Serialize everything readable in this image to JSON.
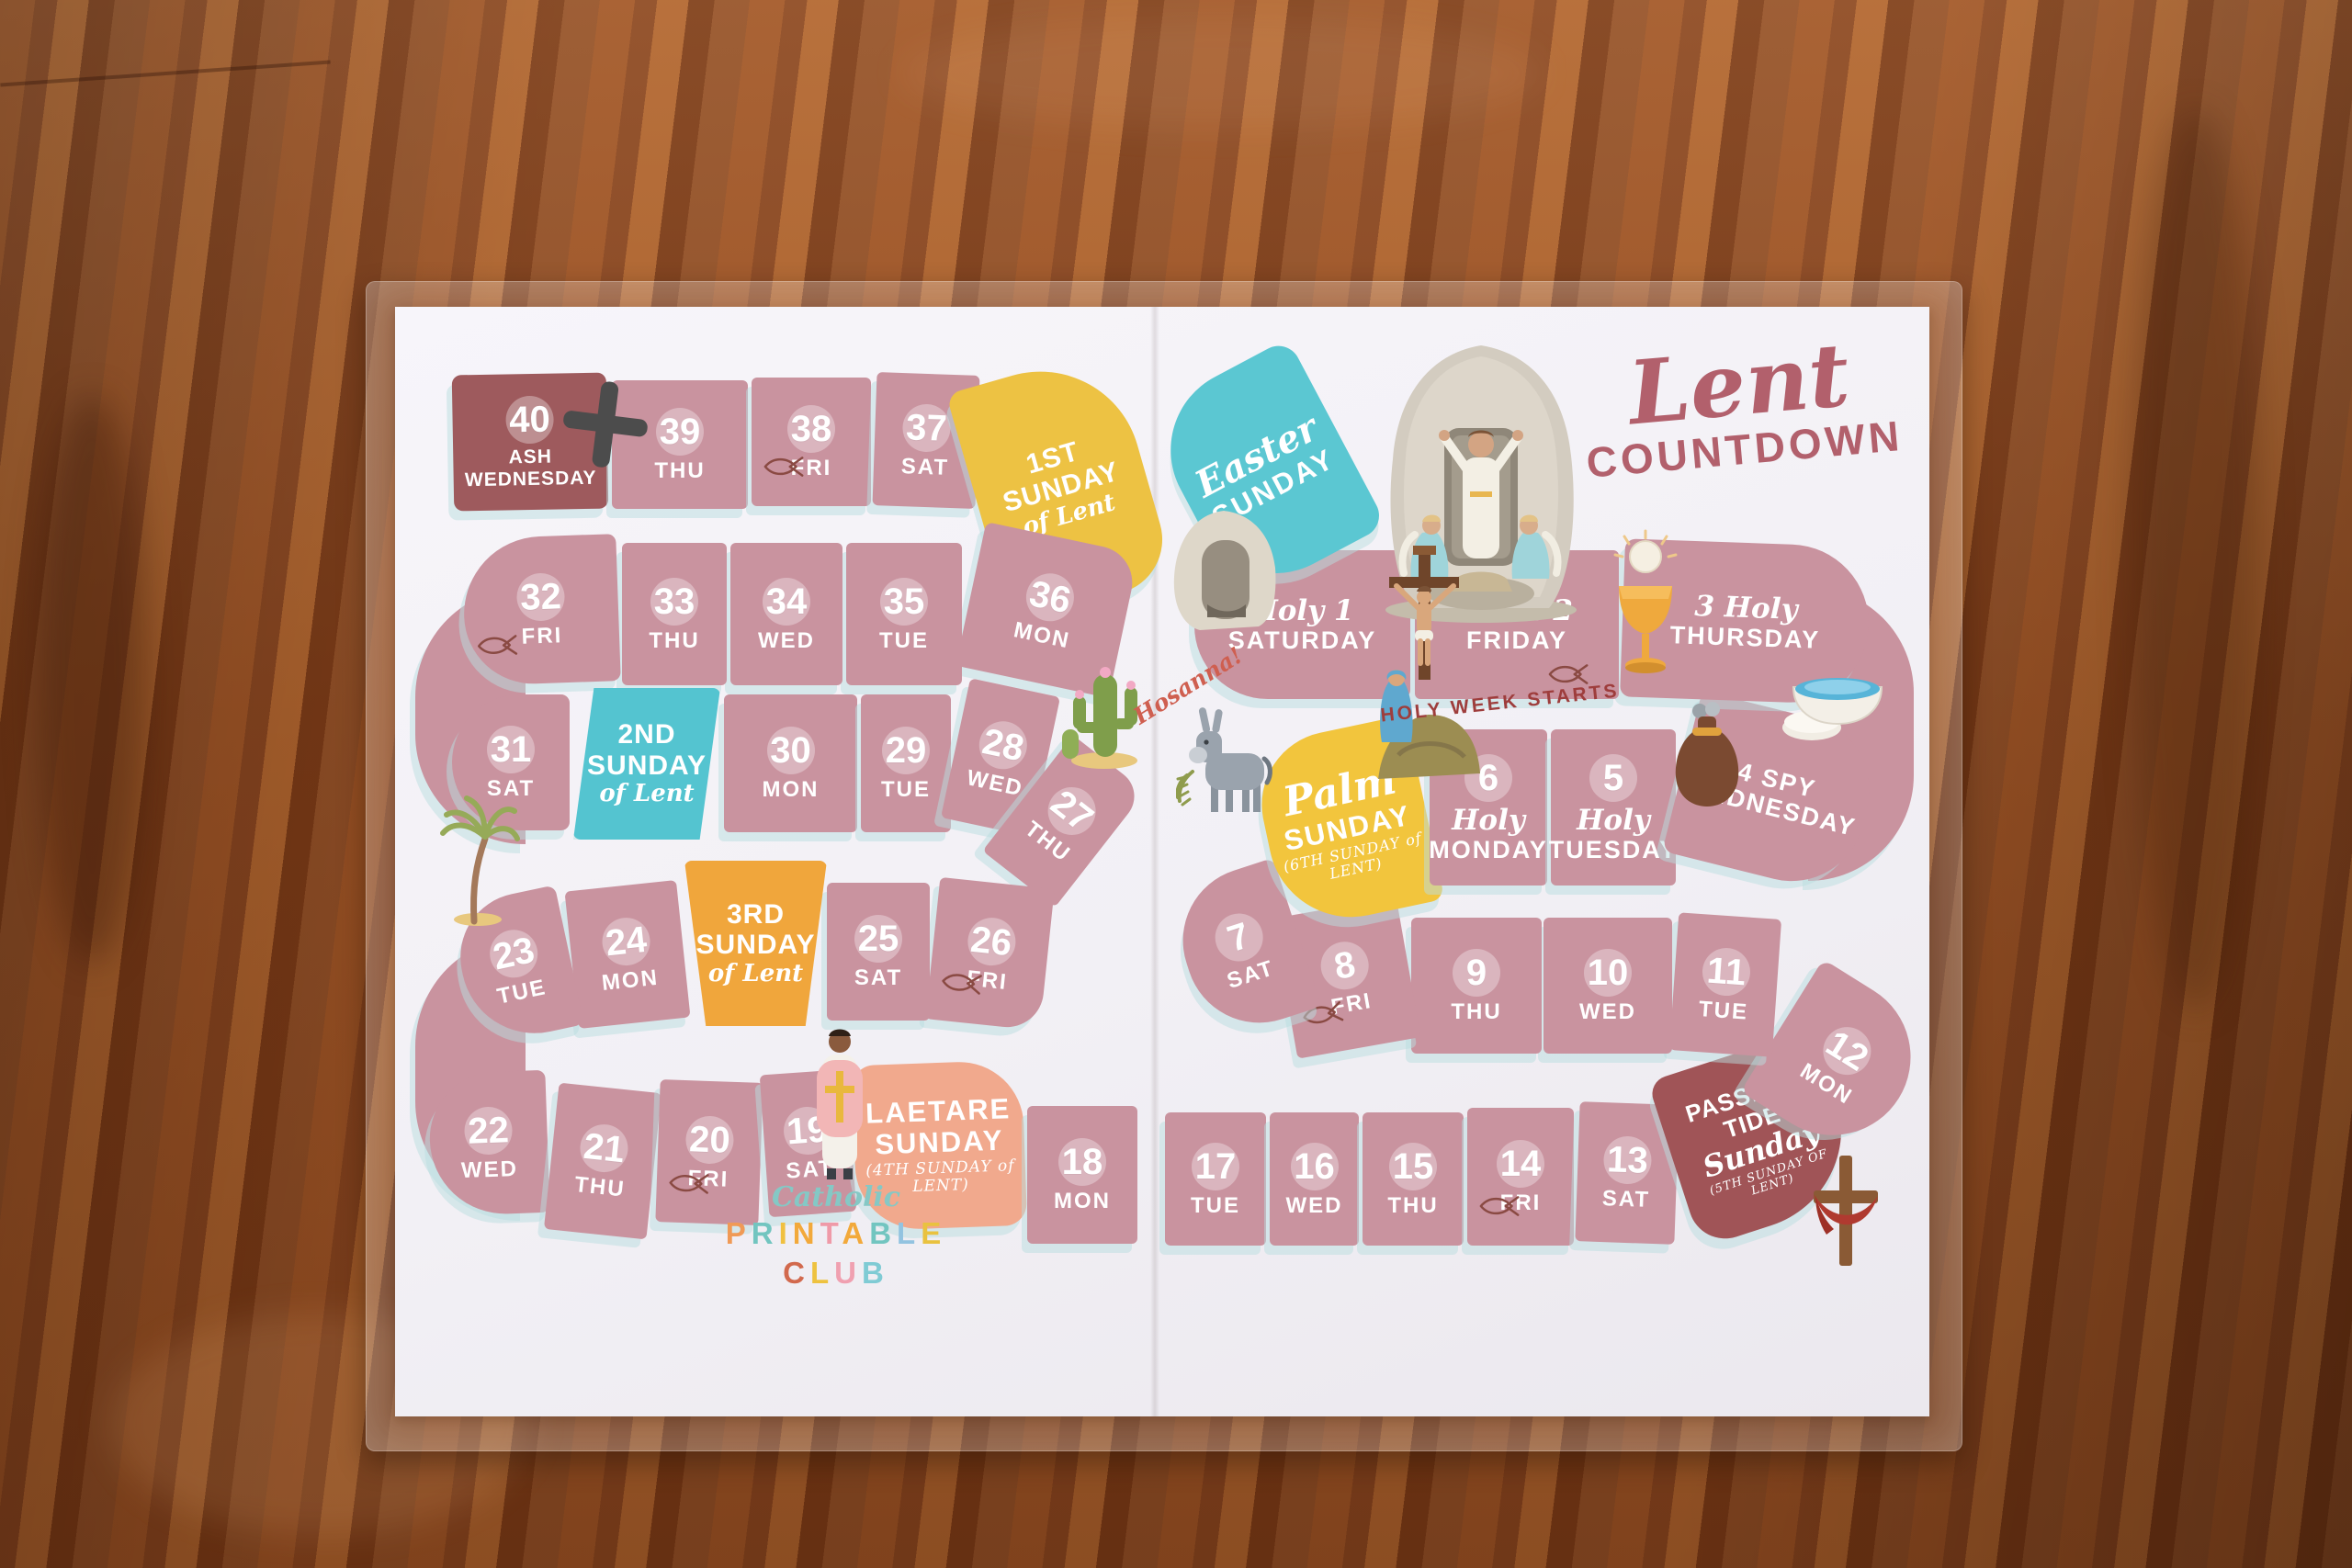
{
  "title": {
    "script": "Lent",
    "caps": "COUNTDOWN"
  },
  "annotations": {
    "hosanna": "Hosanna!",
    "holy_week": "HOLY WEEK STARTS"
  },
  "logo": {
    "script": "Catholic",
    "word1": "PRINTABLE",
    "word1_colors": [
      "#f09a56",
      "#72c5c0",
      "#f0c040",
      "#f2a93b",
      "#ef9aa8",
      "#f2a93b",
      "#72c5c0",
      "#92c3e0",
      "#e9c23f"
    ],
    "word2": "CLUB",
    "word2_colors": [
      "#d2694d",
      "#eec23f",
      "#f0a0b0",
      "#7fcbd4"
    ]
  },
  "colors": {
    "day": "#c9939f",
    "holy": "#c9939f",
    "ash": "#9e5a5d",
    "sunday1": "#edc243",
    "sunday2": "#54c4d0",
    "sunday3": "#f0a63c",
    "laetare": "#f1a98d",
    "passiontide": "#a05457",
    "palm": "#f2c53d",
    "easter": "#5bc7d2",
    "title": "#b2606c",
    "shadow": "#badde0"
  },
  "board": {
    "cells": [
      {
        "id": "d40",
        "num": "40",
        "lines": [
          "ASH",
          "WEDNESDAY"
        ],
        "type": "ash"
      },
      {
        "id": "d39",
        "num": "39",
        "lines": [
          "THU"
        ]
      },
      {
        "id": "d38",
        "num": "38",
        "lines": [
          "FRI"
        ],
        "fish": true
      },
      {
        "id": "d37",
        "num": "37",
        "lines": [
          "SAT"
        ]
      },
      {
        "id": "s1",
        "lines": [
          "1ST",
          "SUNDAY",
          "of Lent"
        ],
        "type": "sunday1"
      },
      {
        "id": "d36",
        "num": "36",
        "lines": [
          "MON"
        ]
      },
      {
        "id": "d35",
        "num": "35",
        "lines": [
          "TUE"
        ]
      },
      {
        "id": "d34",
        "num": "34",
        "lines": [
          "WED"
        ]
      },
      {
        "id": "d33",
        "num": "33",
        "lines": [
          "THU"
        ]
      },
      {
        "id": "d32",
        "num": "32",
        "lines": [
          "FRI"
        ],
        "fish": true
      },
      {
        "id": "d31",
        "num": "31",
        "lines": [
          "SAT"
        ]
      },
      {
        "id": "s2",
        "lines": [
          "2ND",
          "SUNDAY",
          "of Lent"
        ],
        "type": "sunday2"
      },
      {
        "id": "d30",
        "num": "30",
        "lines": [
          "MON"
        ]
      },
      {
        "id": "d29",
        "num": "29",
        "lines": [
          "TUE"
        ]
      },
      {
        "id": "d28",
        "num": "28",
        "lines": [
          "WED"
        ]
      },
      {
        "id": "d27",
        "num": "27",
        "lines": [
          "THU"
        ]
      },
      {
        "id": "d26",
        "num": "26",
        "lines": [
          "FRI"
        ],
        "fish": true
      },
      {
        "id": "d25",
        "num": "25",
        "lines": [
          "SAT"
        ]
      },
      {
        "id": "s3",
        "lines": [
          "3RD",
          "SUNDAY",
          "of Lent"
        ],
        "type": "sunday3"
      },
      {
        "id": "d24",
        "num": "24",
        "lines": [
          "MON"
        ]
      },
      {
        "id": "d23",
        "num": "23",
        "lines": [
          "TUE"
        ]
      },
      {
        "id": "d22",
        "num": "22",
        "lines": [
          "WED"
        ]
      },
      {
        "id": "d21",
        "num": "21",
        "lines": [
          "THU"
        ]
      },
      {
        "id": "d20",
        "num": "20",
        "lines": [
          "FRI"
        ],
        "fish": true
      },
      {
        "id": "d19",
        "num": "19",
        "lines": [
          "SAT"
        ]
      },
      {
        "id": "s4",
        "lines": [
          "LAETARE",
          "SUNDAY",
          "(4TH SUNDAY of LENT)"
        ],
        "type": "laetare"
      },
      {
        "id": "d18",
        "num": "18",
        "lines": [
          "MON"
        ]
      },
      {
        "id": "d17",
        "num": "17",
        "lines": [
          "TUE"
        ]
      },
      {
        "id": "d16",
        "num": "16",
        "lines": [
          "WED"
        ]
      },
      {
        "id": "d15",
        "num": "15",
        "lines": [
          "THU"
        ]
      },
      {
        "id": "d14",
        "num": "14",
        "lines": [
          "FRI"
        ],
        "fish": true
      },
      {
        "id": "d13",
        "num": "13",
        "lines": [
          "SAT"
        ]
      },
      {
        "id": "s5",
        "lines": [
          "PASSION-",
          "TIDE",
          "Sunday",
          "(5TH SUNDAY OF LENT)"
        ],
        "type": "passiontide"
      },
      {
        "id": "d12",
        "num": "12",
        "lines": [
          "MON"
        ]
      },
      {
        "id": "d11",
        "num": "11",
        "lines": [
          "TUE"
        ]
      },
      {
        "id": "d10",
        "num": "10",
        "lines": [
          "WED"
        ]
      },
      {
        "id": "d9",
        "num": "9",
        "lines": [
          "THU"
        ]
      },
      {
        "id": "d8",
        "num": "8",
        "lines": [
          "FRI"
        ],
        "fish": true
      },
      {
        "id": "d7",
        "num": "7",
        "lines": [
          "SAT"
        ]
      },
      {
        "id": "s6",
        "lines": [
          "Palm",
          "SUNDAY",
          "(6TH SUNDAY of LENT)"
        ],
        "type": "palm"
      },
      {
        "id": "d6",
        "num": "6",
        "lines": [
          "Holy",
          "MONDAY"
        ],
        "type": "holy"
      },
      {
        "id": "d5",
        "num": "5",
        "lines": [
          "Holy",
          "TUESDAY"
        ],
        "type": "holy"
      },
      {
        "id": "d4",
        "lines": [
          "4 SPY",
          "WEDNESDAY"
        ],
        "type": "holy"
      },
      {
        "id": "d3",
        "lines": [
          "3 Holy",
          "THURSDAY"
        ],
        "type": "holy"
      },
      {
        "id": "d2",
        "lines": [
          "Good 2",
          "FRIDAY"
        ],
        "type": "holy",
        "fish": true
      },
      {
        "id": "d1",
        "lines": [
          "Holy 1",
          "SATURDAY"
        ],
        "type": "holy"
      },
      {
        "id": "easter",
        "lines": [
          "Easter",
          "SUNDAY"
        ],
        "type": "easter"
      }
    ]
  },
  "decor_icons": [
    "ash-cross-icon",
    "ichthys-fish-icon",
    "palm-tree-icon",
    "cactus-icon",
    "donkey-with-palm-icon",
    "empty-tomb-icon",
    "resurrection-scene-icon",
    "crucifixion-scene-icon",
    "chalice-host-icon",
    "washing-bowl-icon",
    "silver-bag-icon",
    "priest-figure-icon",
    "draped-cross-icon"
  ]
}
